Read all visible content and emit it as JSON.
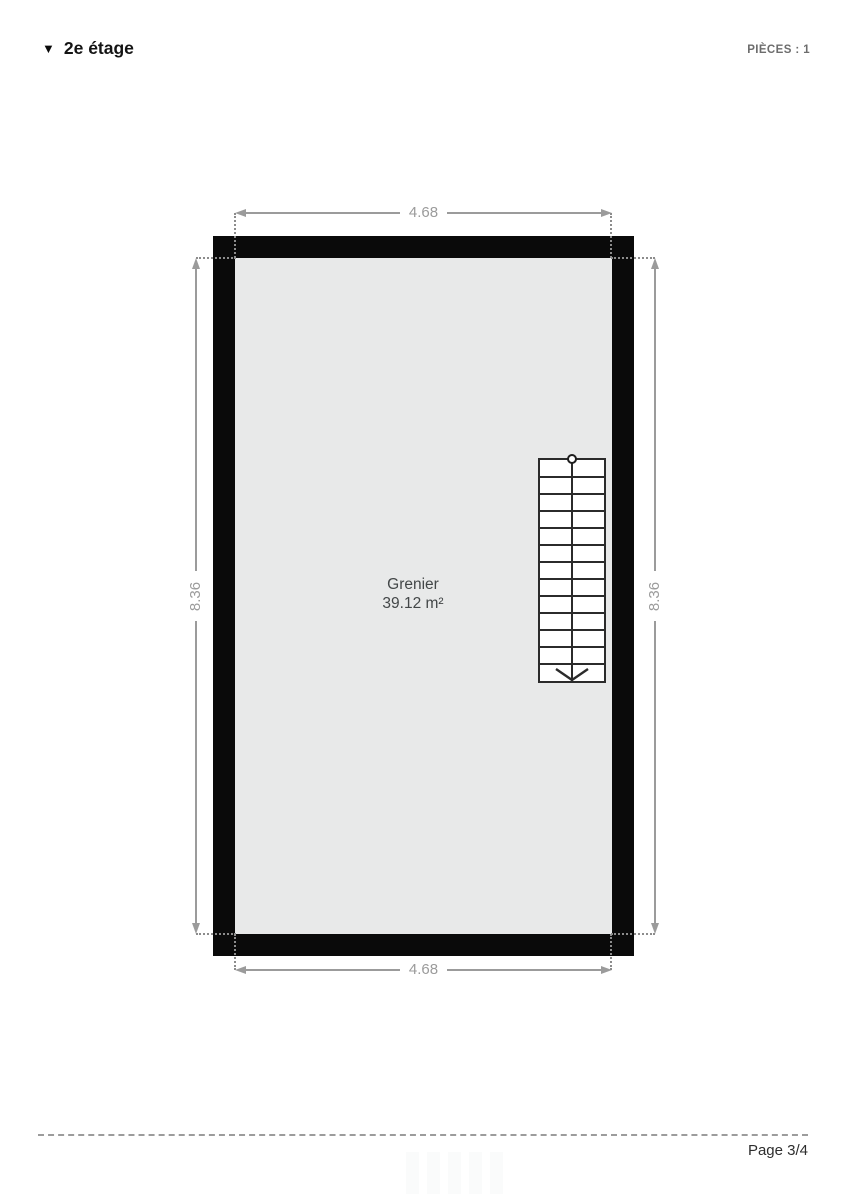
{
  "header": {
    "floor_toggle_icon": "▼",
    "floor_label": "2e étage",
    "pieces_label": "PIÈCES : 1"
  },
  "plan": {
    "room": {
      "name": "Grenier",
      "area": "39.12 m²"
    },
    "dimensions": {
      "width_top": "4.68",
      "width_bottom": "4.68",
      "height_left": "8.36",
      "height_right": "8.36"
    },
    "staircase": {
      "treads": 13,
      "direction": "down"
    }
  },
  "footer": {
    "page_label": "Page 3/4"
  },
  "colors": {
    "wall": "#0a0a0a",
    "room_fill": "#e8e9e9",
    "dimension": "#9b9b9b",
    "room_text": "#434748",
    "muted_text": "#6d6d6d",
    "page_text": "#2e2e2e"
  }
}
